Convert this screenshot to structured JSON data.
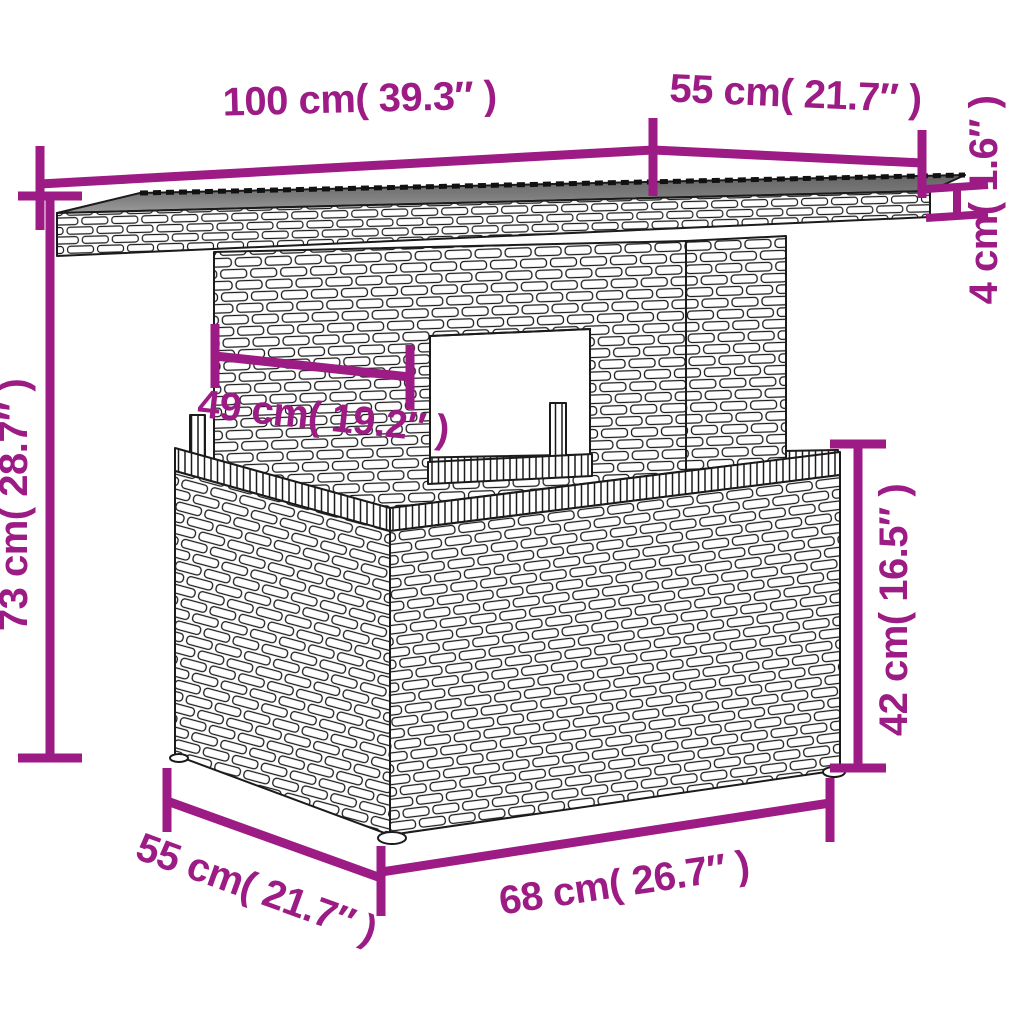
{
  "page": {
    "background": "#ffffff",
    "kind": "product-dimension-diagram",
    "subject": "poly-rattan garden table line drawing with glass top"
  },
  "style": {
    "accent_color": "#9C1B84",
    "line_color": "#1b1b1b",
    "glass_color": "#7c7c7c"
  },
  "dimensions": {
    "top_width": {
      "label": "100 cm( 39.3″ )",
      "cm": 100,
      "inch": 39.3
    },
    "top_depth": {
      "label": "55 cm( 21.7″ )",
      "cm": 55,
      "inch": 21.7
    },
    "top_thickness": {
      "label": "4 cm( 1.6″ )",
      "cm": 4,
      "inch": 1.6
    },
    "total_height": {
      "label": "73 cm( 28.7″ )",
      "cm": 73,
      "inch": 28.7
    },
    "pedestal_width": {
      "label": "49 cm( 19.2″ )",
      "cm": 49,
      "inch": 19.2
    },
    "base_height": {
      "label": "42 cm( 16.5″ )",
      "cm": 42,
      "inch": 16.5
    },
    "base_depth": {
      "label": "55 cm( 21.7″ )",
      "cm": 55,
      "inch": 21.7
    },
    "base_width": {
      "label": "68 cm( 26.7″ )",
      "cm": 68,
      "inch": 26.7
    }
  }
}
